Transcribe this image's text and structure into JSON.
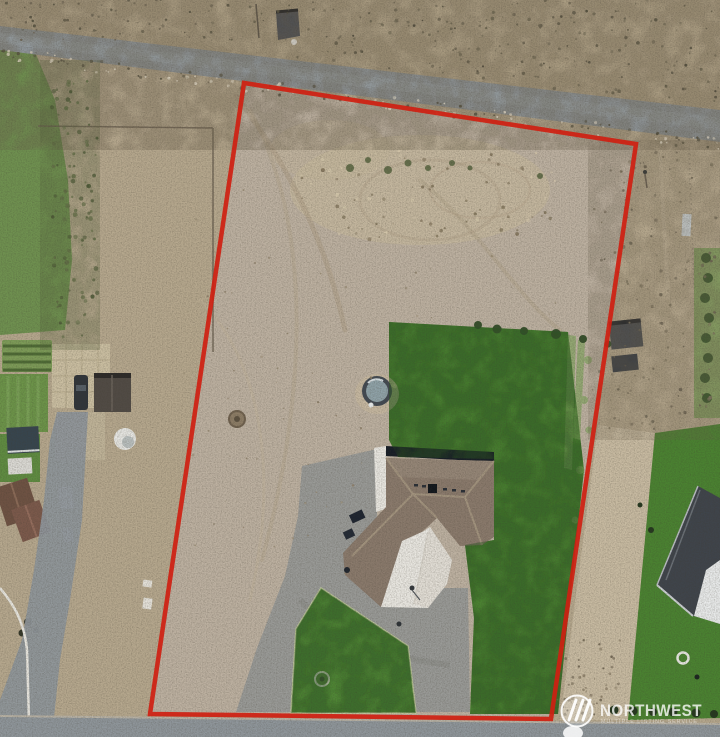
{
  "image": {
    "width": 720,
    "height": 737
  },
  "watermark": {
    "brand": "NORTHWEST",
    "tagline": "MULTIPLE LISTING SERVICE",
    "logo": "three-slash-circle-icon"
  },
  "boundary": {
    "color": "#cf2011",
    "stroke_width": 4.5,
    "corners": [
      [
        244,
        83
      ],
      [
        636,
        144
      ],
      [
        551,
        719
      ],
      [
        150,
        714
      ]
    ]
  },
  "colors": {
    "dirt": "#b6a88e",
    "lot_dirt": "#bdb1a1",
    "road": "#8f969b",
    "lawn": "#4a8231",
    "lawn_light": "#63984a",
    "roof": "#8a7a6c",
    "concrete": "#e9e7e1",
    "boundary_red": "#cf2011",
    "watermark_text": "rgba(255,255,255,0.78)"
  }
}
